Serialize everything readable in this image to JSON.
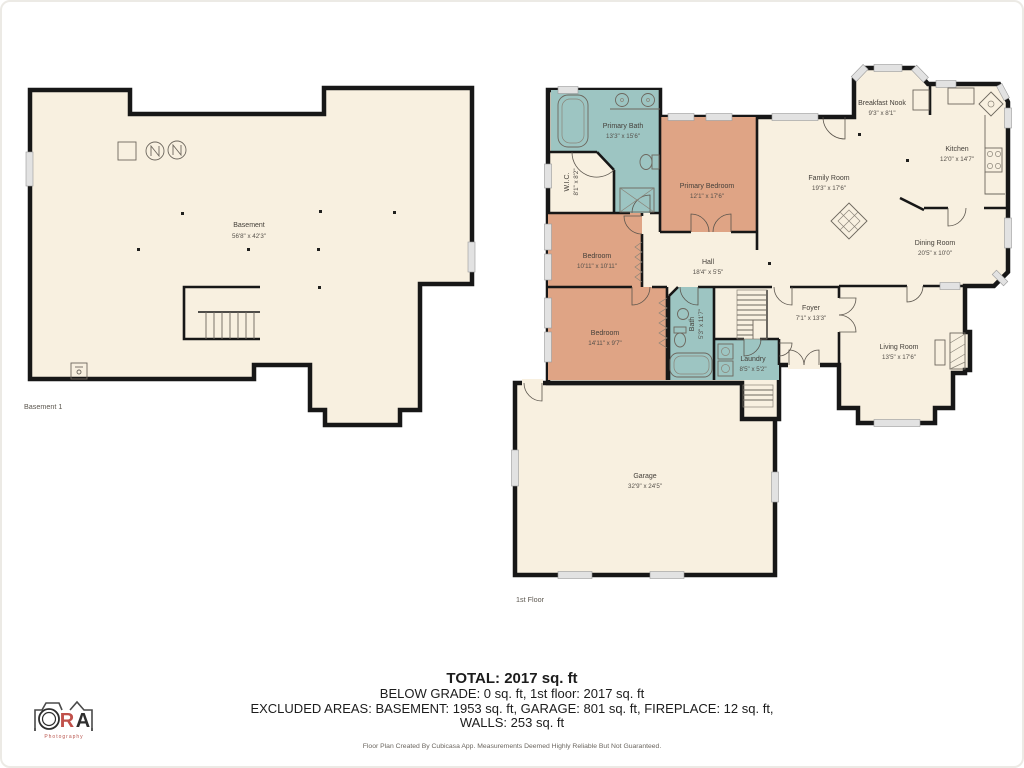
{
  "palette": {
    "floor": "#f8f0e0",
    "wall": "#171717",
    "wet_room": "#9dc5c2",
    "bedroom": "#dfa485",
    "window": "#e2e2e2",
    "label_text": "#45403a",
    "logo_accent": "#c0504a"
  },
  "basement": {
    "floor_label": "Basement 1",
    "rooms": {
      "basement": {
        "name": "Basement",
        "dims": "56'8\" x 42'3\""
      }
    }
  },
  "first_floor": {
    "floor_label": "1st Floor",
    "rooms": {
      "primary_bath": {
        "name": "Primary Bath",
        "dims": "13'3\" x 15'6\""
      },
      "wic": {
        "name": "W.I.C.",
        "dims": "8'1\" x 8'2\""
      },
      "primary_bedroom": {
        "name": "Primary Bedroom",
        "dims": "12'1\" x 17'6\""
      },
      "bedroom_a": {
        "name": "Bedroom",
        "dims": "10'11\" x 10'11\""
      },
      "bedroom_b": {
        "name": "Bedroom",
        "dims": "14'11\" x 9'7\""
      },
      "hall": {
        "name": "Hall",
        "dims": "18'4\" x 5'5\""
      },
      "bath": {
        "name": "Bath",
        "dims": "5'3\" x 11'7\""
      },
      "laundry": {
        "name": "Laundry",
        "dims": "8'5\" x 5'2\""
      },
      "foyer": {
        "name": "Foyer",
        "dims": "7'1\" x 13'3\""
      },
      "family_room": {
        "name": "Family Room",
        "dims": "19'3\" x 17'6\""
      },
      "breakfast_nook": {
        "name": "Breakfast Nook",
        "dims": "9'3\" x 8'1\""
      },
      "kitchen": {
        "name": "Kitchen",
        "dims": "12'0\" x 14'7\""
      },
      "dining_room": {
        "name": "Dining Room",
        "dims": "20'5\" x 10'0\""
      },
      "living_room": {
        "name": "Living Room",
        "dims": "13'5\" x 17'6\""
      },
      "garage": {
        "name": "Garage",
        "dims": "32'9\" x 24'5\""
      }
    }
  },
  "summary": {
    "total": "TOTAL: 2017 sq. ft",
    "below_grade": "BELOW GRADE: 0 sq. ft, 1st floor: 2017 sq. ft",
    "excluded": "EXCLUDED AREAS: BASEMENT: 1953 sq. ft, GARAGE: 801 sq. ft, FIREPLACE: 12 sq. ft,",
    "walls": "WALLS: 253 sq. ft"
  },
  "footnote": "Floor Plan Created By Cubicasa App. Measurements Deemed Highly Reliable But Not Guaranteed.",
  "logo": {
    "r": "R",
    "a": "A",
    "sub": "Photography"
  }
}
